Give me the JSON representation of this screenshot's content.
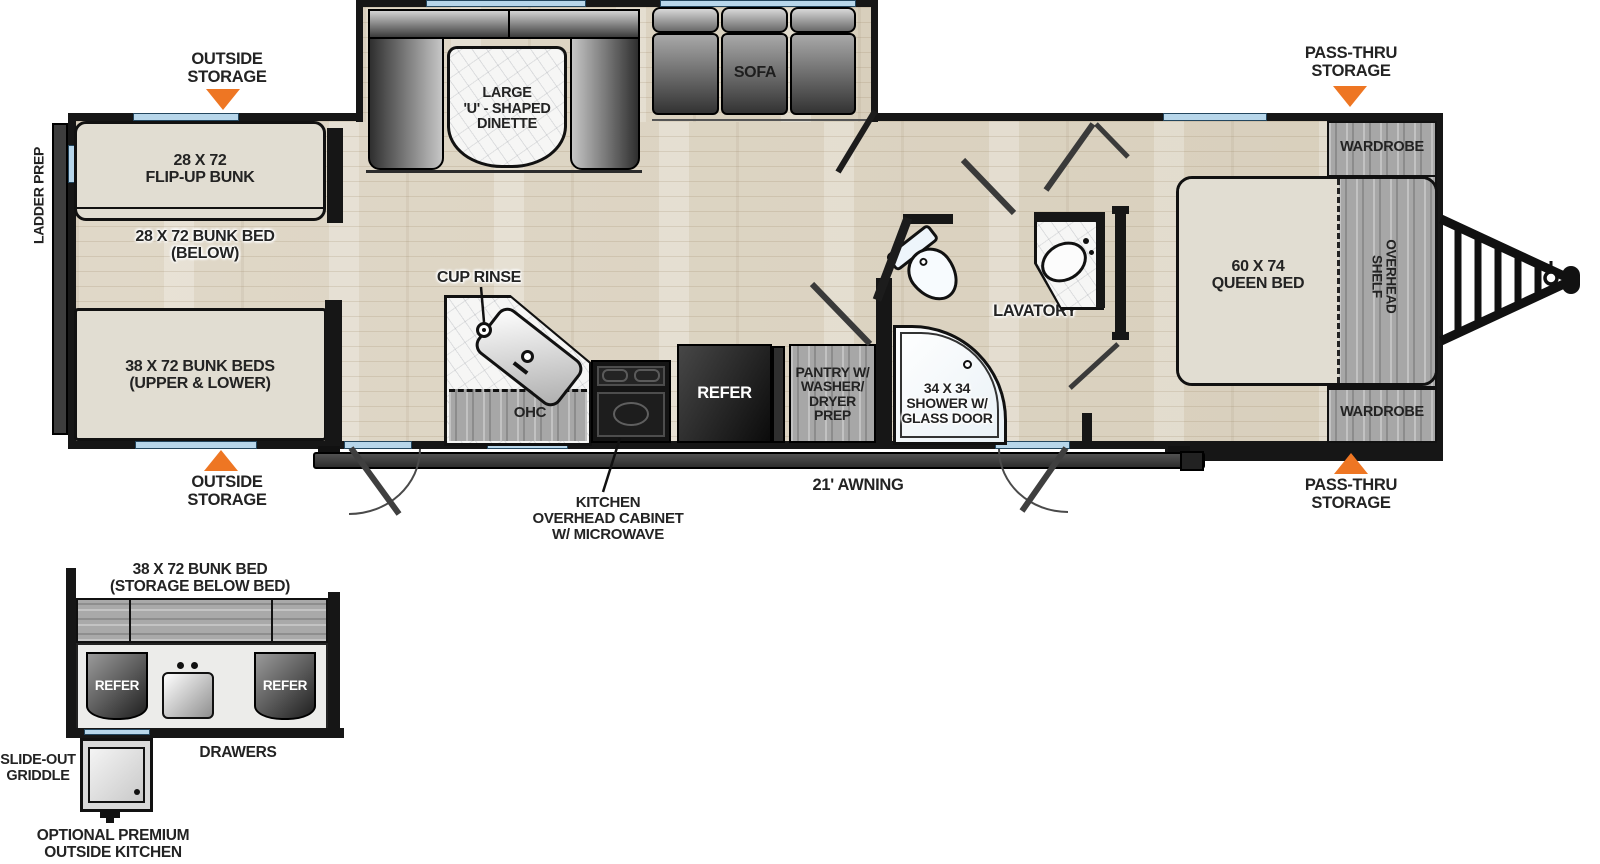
{
  "colors": {
    "accent_orange": "#ee7623",
    "wall_black": "#161616",
    "window_blue": "#b7d6ea",
    "floor_beige": "#ddd5c4",
    "furniture_beige": "#e1ddd2",
    "cabinet_gray": "#a7a7a7"
  },
  "callouts": {
    "outside_storage_top": "OUTSIDE\nSTORAGE",
    "outside_storage_bottom": "OUTSIDE\nSTORAGE",
    "pass_thru_top": "PASS-THRU\nSTORAGE",
    "pass_thru_bottom": "PASS-THRU\nSTORAGE",
    "ladder_prep": "LADDER PREP",
    "awning": "21' AWNING",
    "kitchen_ohc": "KITCHEN\nOVERHEAD CABINET\nW/ MICROWAVE",
    "cup_rinse": "CUP RINSE"
  },
  "rooms": {
    "flip_up_bunk": "28 X 72\nFLIP-UP BUNK",
    "bunk_below": "28 X 72 BUNK BED\n(BELOW)",
    "bunk_beds": "38 X 72 BUNK BEDS\n(UPPER & LOWER)",
    "dinette": "LARGE\n'U' - SHAPED\nDINETTE",
    "sofa": "SOFA",
    "ohc": "OHC",
    "refer": "REFER",
    "pantry": "PANTRY W/\nWASHER/\nDRYER\nPREP",
    "shower": "34 X 34\nSHOWER W/\nGLASS DOOR",
    "lavatory": "LAVATORY",
    "queen_bed": "60 X 74\nQUEEN BED",
    "overhead_shelf": "OVERHEAD\nSHELF",
    "wardrobe_top": "WARDROBE",
    "wardrobe_bottom": "WARDROBE"
  },
  "outside_kitchen": {
    "title": "38 X 72 BUNK BED\n(STORAGE BELOW BED)",
    "refer_left": "REFER",
    "refer_right": "REFER",
    "drawers": "DRAWERS",
    "slide_out_griddle": "SLIDE-OUT\nGRIDDLE",
    "optional": "OPTIONAL PREMIUM\nOUTSIDE KITCHEN"
  }
}
